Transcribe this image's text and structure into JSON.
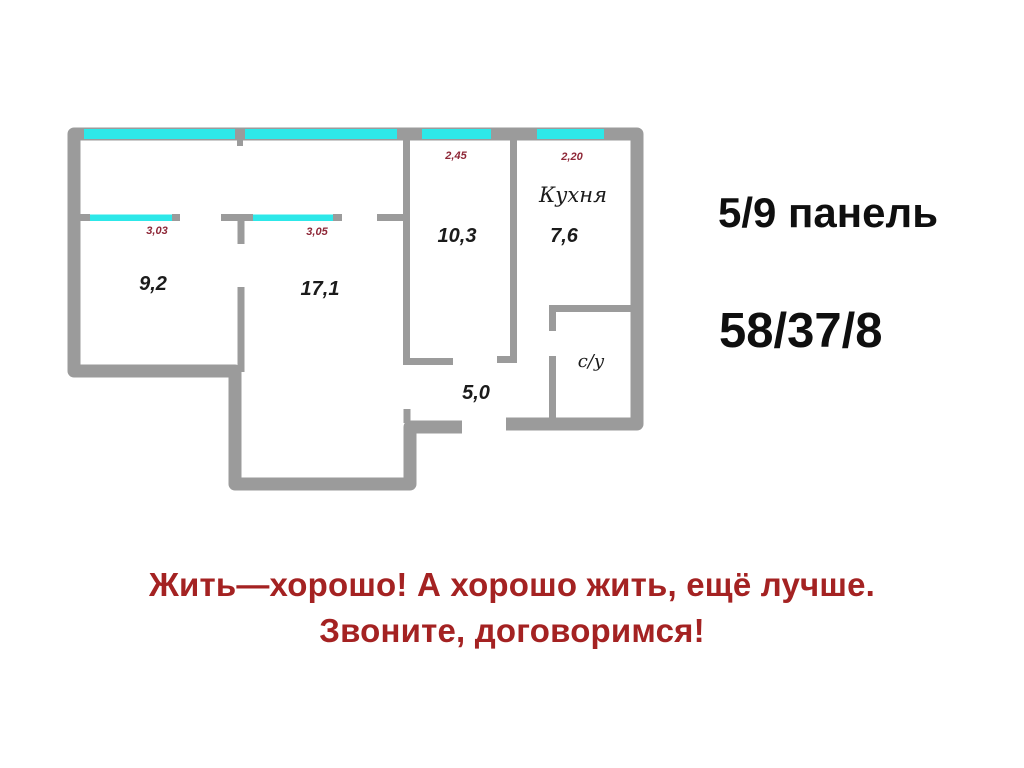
{
  "colors": {
    "wall": "#9b9b9b",
    "window": "#2de8e9",
    "dimension": "#8e2737",
    "room_text": "#1b1b1b",
    "info_text": "#0f0f0f",
    "slogan": "#a42222"
  },
  "plan": {
    "rooms": {
      "room1_area": "9,2",
      "room2_area": "17,1",
      "room3_area": "10,3",
      "kitchen_name": "Кухня",
      "kitchen_area": "7,6",
      "hall_area": "5,0",
      "bathroom_name": "с/у"
    },
    "dimensions": {
      "room1_width": "3,03",
      "room2_width": "3,05",
      "room3_width": "2,45",
      "kitchen_width": "2,20"
    }
  },
  "info": {
    "floor": "5/9 панель",
    "metrics": "58/37/8"
  },
  "slogan": {
    "line1": "Жить—хорошо! А хорошо жить, ещё лучше.",
    "line2": "Звоните, договоримся!"
  }
}
